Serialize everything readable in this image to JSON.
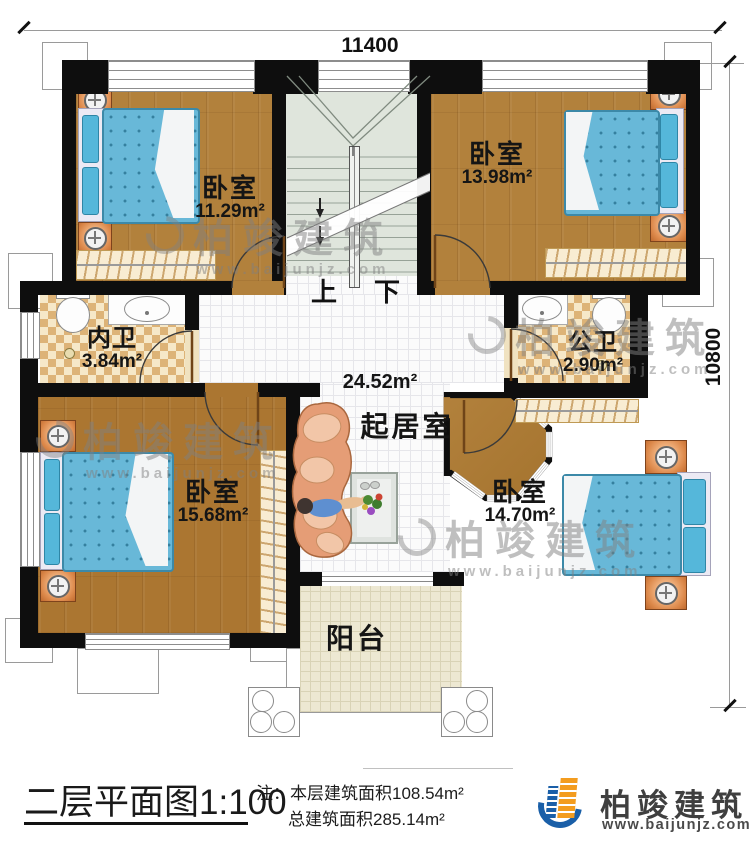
{
  "dimensions": {
    "width_label": "11400",
    "height_label": "10800"
  },
  "stairs": {
    "up_label": "上",
    "down_label": "下"
  },
  "rooms": {
    "bedroom_top_left": {
      "name": "卧室",
      "area": "11.29m²"
    },
    "bedroom_top_right": {
      "name": "卧室",
      "area": "13.98m²"
    },
    "bedroom_bottom_left": {
      "name": "卧室",
      "area": "15.68m²"
    },
    "bedroom_bottom_right": {
      "name": "卧室",
      "area": "14.70m²"
    },
    "inner_bath": {
      "name": "内卫",
      "area": "3.84m²"
    },
    "public_bath": {
      "name": "公卫",
      "area": "2.90m²"
    },
    "living_room": {
      "name": "起居室",
      "area": "24.52m²"
    },
    "balcony": {
      "name": "阳台"
    }
  },
  "title_block": {
    "title": "二层平面图",
    "scale": "1:100",
    "note_prefix": "注：",
    "note_line1": "本层建筑面积108.54m²",
    "note_line2": "总建筑面积285.14m²"
  },
  "branding": {
    "company": "柏竣建筑",
    "website": "www.baijunjz.com"
  },
  "watermark": {
    "text": "柏竣建筑",
    "url": "www.baijunjz.com"
  },
  "colors": {
    "wall": "#0e0e0e",
    "wood": "#b2813c",
    "tile_check": "#ddb377",
    "stair": "#dfe5dc",
    "mattress": "#68b8d8",
    "nightstand": "#dd8a4c",
    "logo_blue": "#1a5fa8",
    "logo_orange": "#f39c1f"
  }
}
